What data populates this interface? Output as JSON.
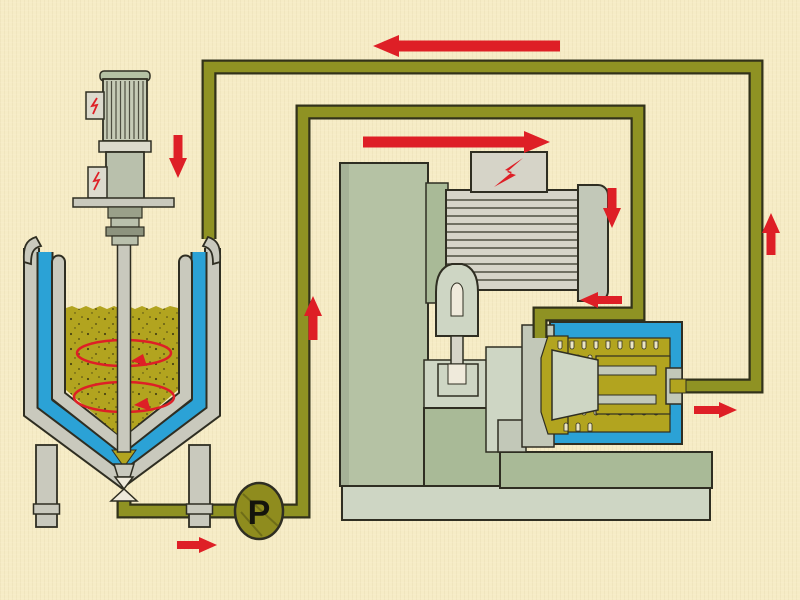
{
  "diagram": {
    "type": "process-flow-circulation-diagram",
    "pump": {
      "label": "P"
    },
    "colors": {
      "background": "#f6ecc6",
      "outline": "#2f2e22",
      "pipe": "#8f9223",
      "pipe_edge": "#32321a",
      "product": "#b2a41f",
      "jacket_blue": "#2ba2d6",
      "arrow_red": "#de1f26",
      "steel": "#c9c9bd",
      "steel_light": "#dcdacd",
      "cabinet_sage": "#b5c2a4",
      "sage_dark": "#a9ba97",
      "base_light": "#ced6c4",
      "motor_gray": "#d6d4c8",
      "gray_block": "#c2c8b8",
      "pump_olive": "#8f8c1e",
      "tooth_cream": "#ece5c2"
    },
    "components": [
      "agitator-motor",
      "mixing-tank",
      "cooling-jacket",
      "product-liquid",
      "agitator-shaft",
      "drain-valve",
      "tank-legs",
      "circulation-pump",
      "control-cabinet",
      "mill-motor",
      "motor-terminal-box",
      "drive-coupling",
      "machine-base",
      "mill-housing",
      "mill-rotor-cone",
      "grinding-channel",
      "outlet-flange",
      "feed-pipe",
      "return-pipe"
    ],
    "flow_arrows": [
      {
        "id": "return-into-tank",
        "direction": "down"
      },
      {
        "id": "return-top-run",
        "direction": "left"
      },
      {
        "id": "feed-top-run",
        "direction": "right"
      },
      {
        "id": "mill-outlet-riser",
        "direction": "up"
      },
      {
        "id": "feed-down-leg",
        "direction": "down"
      },
      {
        "id": "pump-riser",
        "direction": "up"
      },
      {
        "id": "mill-inlet",
        "direction": "left"
      },
      {
        "id": "mill-outlet",
        "direction": "right"
      },
      {
        "id": "tank-to-pump",
        "direction": "right"
      }
    ]
  }
}
